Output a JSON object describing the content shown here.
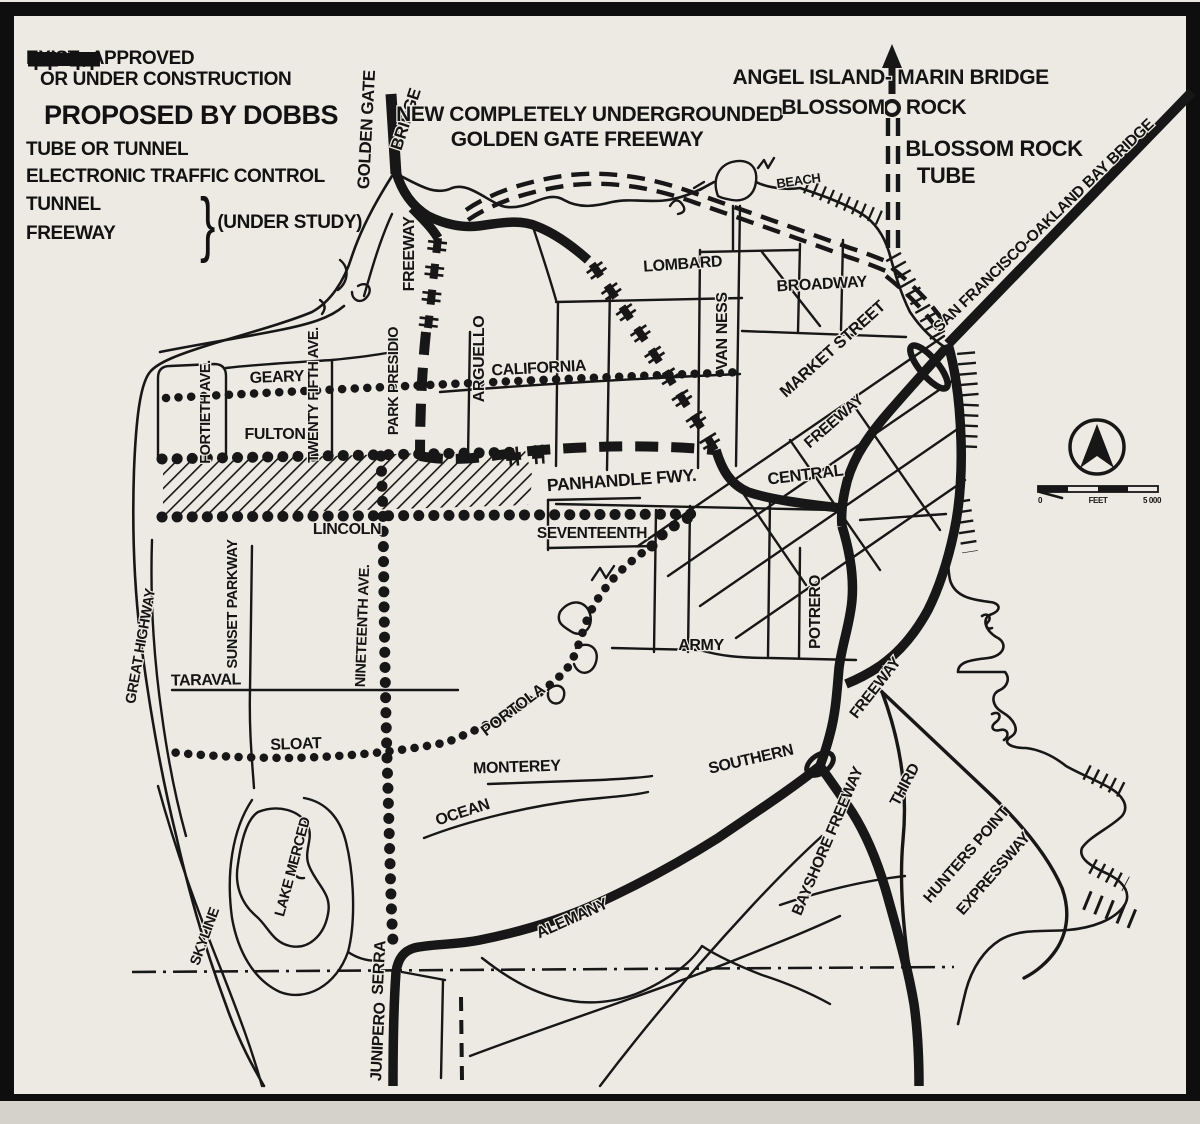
{
  "colors": {
    "paper": "#edeae3",
    "ink": "#171717"
  },
  "legend": {
    "existing_label_line1": "EXIST., APPROVED",
    "existing_label_line2": "OR UNDER CONSTRUCTION",
    "proposed_header": "PROPOSED BY DOBBS",
    "tube_label": "TUBE OR TUNNEL",
    "etc_label": "ELECTRONIC TRAFFIC CONTROL",
    "tunnel_label": "TUNNEL",
    "freeway_label": "FREEWAY",
    "under_study_label": "(UNDER STUDY)"
  },
  "scale": {
    "start": "0",
    "unit": "FEET",
    "end": "5 000"
  },
  "map_labels": [
    {
      "text": "GOLDEN GATE",
      "x": 372,
      "y": 130,
      "rot": -87,
      "size": 17
    },
    {
      "text": "BRIDGE",
      "x": 411,
      "y": 121,
      "rot": -72,
      "size": 17
    },
    {
      "text": "NEW COMPLETELY UNDERGROUNDED",
      "x": 590,
      "y": 121,
      "rot": 0,
      "size": 21
    },
    {
      "text": "GOLDEN GATE FREEWAY",
      "x": 577,
      "y": 146,
      "rot": 0,
      "size": 21
    },
    {
      "text": "ANGEL ISLAND-",
      "x": 812,
      "y": 84,
      "rot": 0,
      "size": 21
    },
    {
      "text": "MARIN BRIDGE",
      "x": 973,
      "y": 84,
      "rot": 0,
      "size": 21
    },
    {
      "text": "BLOSSOM",
      "x": 833,
      "y": 114,
      "rot": 0,
      "size": 21
    },
    {
      "text": "ROCK",
      "x": 936,
      "y": 114,
      "rot": 0,
      "size": 21
    },
    {
      "text": "BLOSSOM ROCK",
      "x": 994,
      "y": 156,
      "rot": 0,
      "size": 22
    },
    {
      "text": "TUBE",
      "x": 946,
      "y": 183,
      "rot": 0,
      "size": 22
    },
    {
      "text": "SAN FRANCISCO-OAKLAND BAY BRIDGE",
      "x": 1047,
      "y": 229,
      "rot": -44,
      "size": 15.5
    },
    {
      "text": "BEACH",
      "x": 799,
      "y": 185,
      "rot": -8,
      "size": 13
    },
    {
      "text": "FREEWAY",
      "x": 414,
      "y": 254,
      "rot": -90,
      "size": 16
    },
    {
      "text": "LOMBARD",
      "x": 683,
      "y": 269,
      "rot": -4,
      "size": 16
    },
    {
      "text": "BROADWAY",
      "x": 822,
      "y": 289,
      "rot": -3,
      "size": 16
    },
    {
      "text": "VAN NESS",
      "x": 727,
      "y": 331,
      "rot": -90,
      "size": 16
    },
    {
      "text": "MARKET STREET",
      "x": 836,
      "y": 353,
      "rot": -42,
      "size": 16.5
    },
    {
      "text": "FREEWAY",
      "x": 837,
      "y": 425,
      "rot": -41,
      "size": 15.5
    },
    {
      "text": "ARGUELLO",
      "x": 484,
      "y": 359,
      "rot": -90,
      "size": 16
    },
    {
      "text": "CALIFORNIA",
      "x": 539,
      "y": 373,
      "rot": -3,
      "size": 16
    },
    {
      "text": "GEARY",
      "x": 277,
      "y": 382,
      "rot": -2,
      "size": 16
    },
    {
      "text": "FORTIETH AVE.",
      "x": 210,
      "y": 412,
      "rot": -90,
      "size": 14.5
    },
    {
      "text": "TWENTY FIFTH AVE.",
      "x": 318,
      "y": 395,
      "rot": -90,
      "size": 14.5
    },
    {
      "text": "PARK PRESIDIO",
      "x": 398,
      "y": 381,
      "rot": -90,
      "size": 14.5
    },
    {
      "text": "FULTON",
      "x": 275,
      "y": 439,
      "rot": 0,
      "size": 16
    },
    {
      "text": "PANHANDLE FWY.",
      "x": 622,
      "y": 486,
      "rot": -4,
      "size": 17.5
    },
    {
      "text": "CENTRAL",
      "x": 806,
      "y": 480,
      "rot": -7,
      "size": 16.5
    },
    {
      "text": "SEVENTEENTH",
      "x": 592,
      "y": 538,
      "rot": 0,
      "size": 15.5
    },
    {
      "text": "LINCOLN",
      "x": 347,
      "y": 534,
      "rot": 0,
      "size": 16
    },
    {
      "text": "POTRERO",
      "x": 820,
      "y": 612,
      "rot": -90,
      "size": 15.5
    },
    {
      "text": "ARMY",
      "x": 701,
      "y": 650,
      "rot": 0,
      "size": 16
    },
    {
      "text": "FREEWAY",
      "x": 879,
      "y": 691,
      "rot": -52,
      "size": 15.5
    },
    {
      "text": "SOUTHERN",
      "x": 752,
      "y": 764,
      "rot": -13,
      "size": 16
    },
    {
      "text": "THIRD",
      "x": 909,
      "y": 787,
      "rot": -62,
      "size": 15.5
    },
    {
      "text": "BAYSHORE FREEWAY",
      "x": 832,
      "y": 843,
      "rot": -67,
      "size": 15.5
    },
    {
      "text": "HUNTERS POINT",
      "x": 970,
      "y": 858,
      "rot": -49,
      "size": 15.5
    },
    {
      "text": "EXPRESSWAY",
      "x": 997,
      "y": 877,
      "rot": -49,
      "size": 15.5
    },
    {
      "text": "GREAT HIGHWAY",
      "x": 145,
      "y": 647,
      "rot": -80,
      "size": 14.5
    },
    {
      "text": "SUNSET PARKWAY",
      "x": 237,
      "y": 604,
      "rot": -90,
      "size": 14.5
    },
    {
      "text": "NINETEENTH AVE.",
      "x": 367,
      "y": 626,
      "rot": -88,
      "size": 14.5
    },
    {
      "text": "TARAVAL",
      "x": 206,
      "y": 685,
      "rot": -1,
      "size": 16
    },
    {
      "text": "SLOAT",
      "x": 296,
      "y": 749,
      "rot": -2,
      "size": 16
    },
    {
      "text": "PORTOLA",
      "x": 516,
      "y": 714,
      "rot": -37,
      "size": 16
    },
    {
      "text": "MONTEREY",
      "x": 517,
      "y": 772,
      "rot": -2,
      "size": 16
    },
    {
      "text": "OCEAN",
      "x": 464,
      "y": 817,
      "rot": -18,
      "size": 16
    },
    {
      "text": "LAKE MERCED",
      "x": 297,
      "y": 868,
      "rot": -75,
      "size": 14.5
    },
    {
      "text": "SKYLINE",
      "x": 209,
      "y": 938,
      "rot": -70,
      "size": 14.5
    },
    {
      "text": "SERRA",
      "x": 384,
      "y": 968,
      "rot": -87,
      "size": 16
    },
    {
      "text": "JUNIPERO",
      "x": 383,
      "y": 1042,
      "rot": -87,
      "size": 16
    },
    {
      "text": "ALEMANY",
      "x": 574,
      "y": 923,
      "rot": -24,
      "size": 16
    }
  ]
}
